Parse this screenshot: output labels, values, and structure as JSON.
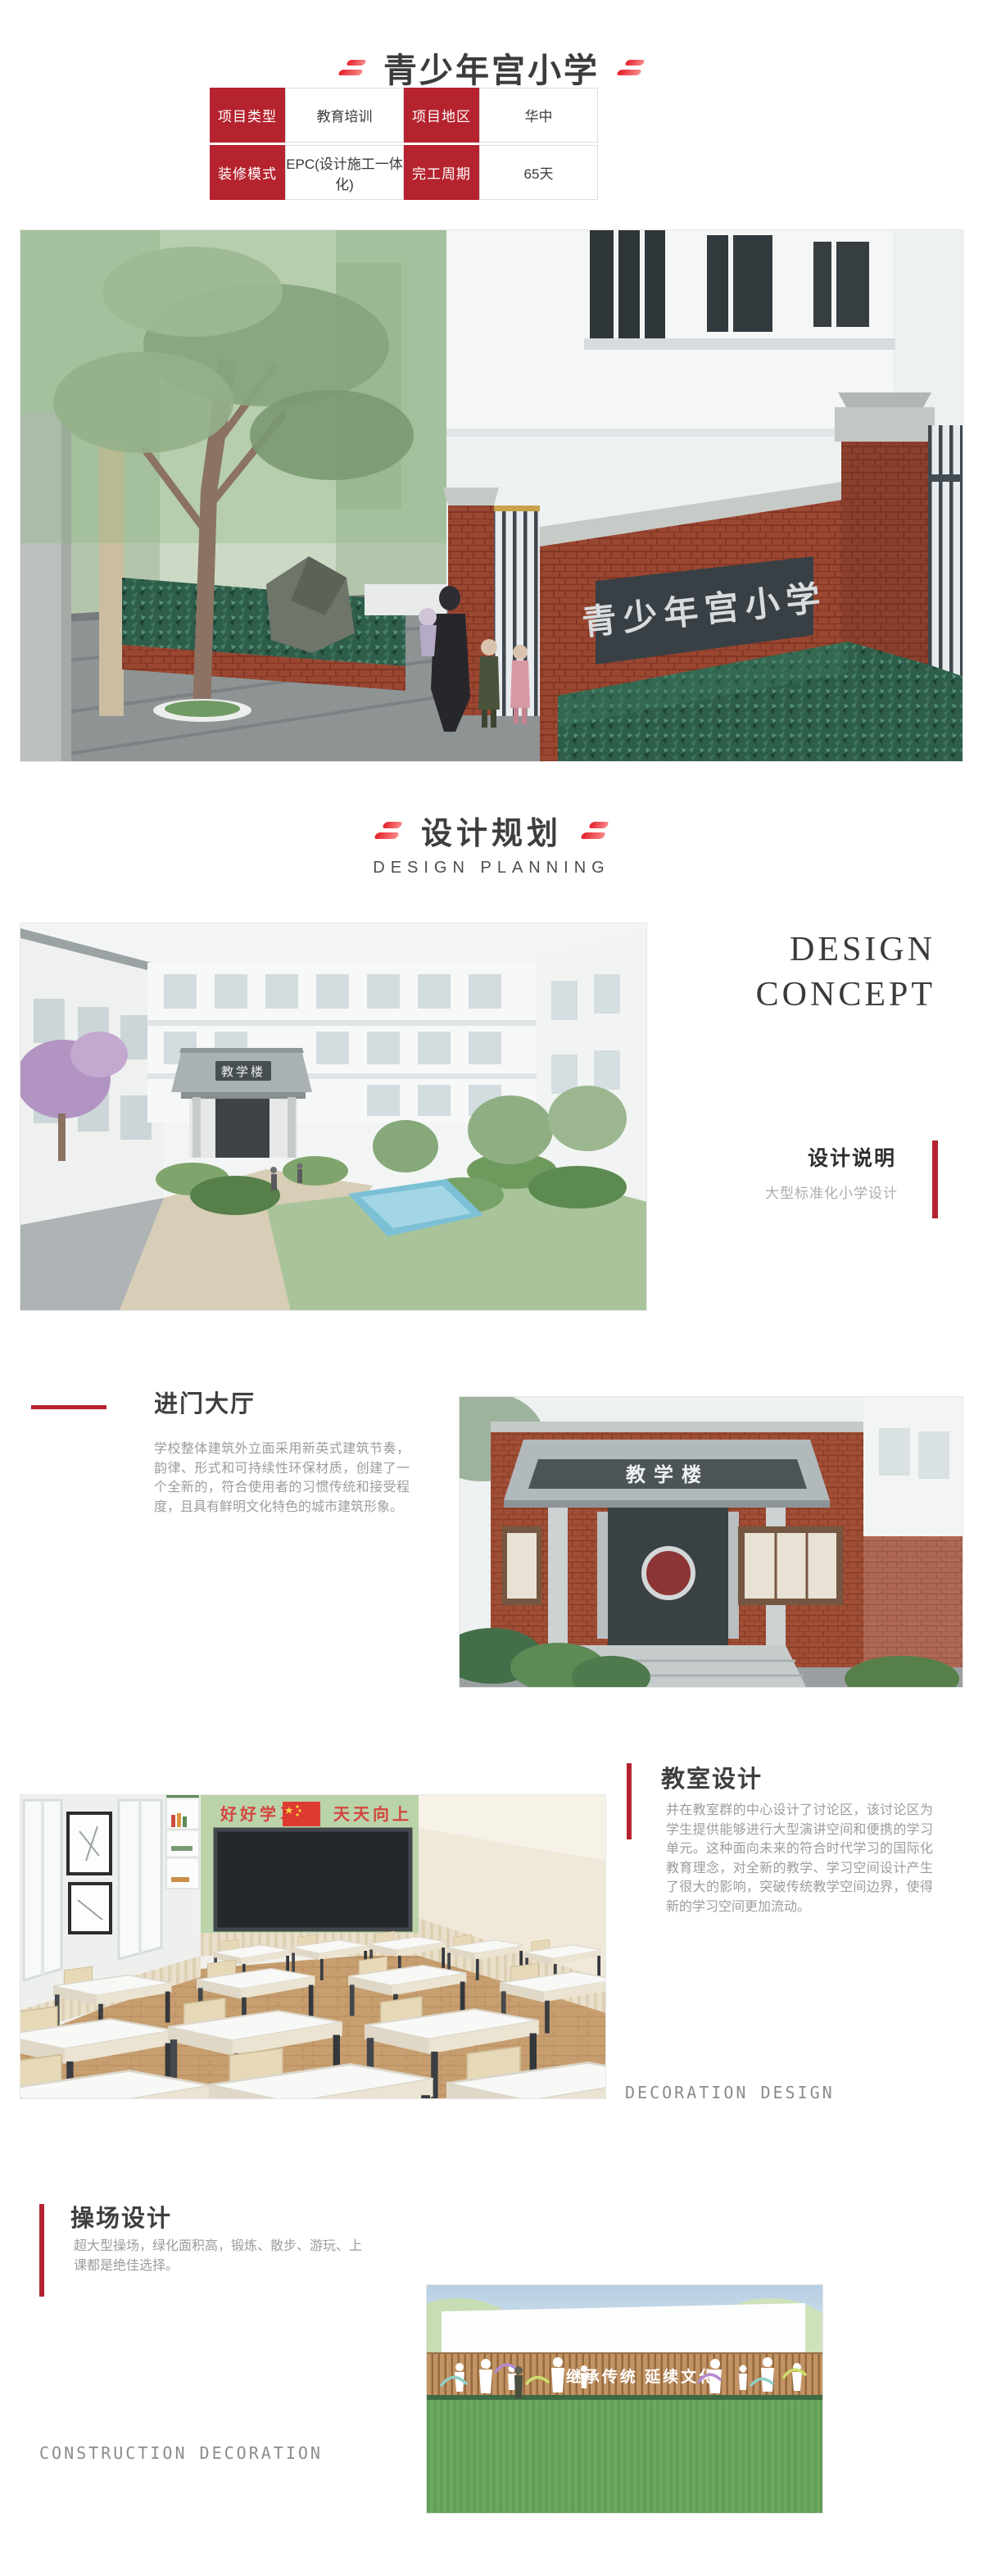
{
  "colors": {
    "accent_red": "#b5232f",
    "dash_red": "#e3202a",
    "slogan_red": "#d4453e"
  },
  "page": {
    "title": "青少年宫小学"
  },
  "info_table": {
    "rows": [
      {
        "cells": [
          {
            "text": "项目类型"
          },
          {
            "text": "教育培训"
          },
          {
            "text": "项目地区"
          },
          {
            "text": "华中"
          }
        ]
      },
      {
        "cells": [
          {
            "text": "装修模式"
          },
          {
            "text": "EPC(设计施工一体化)"
          },
          {
            "text": "完工周期"
          },
          {
            "text": "65天"
          }
        ]
      }
    ]
  },
  "section_header": {
    "title_cn": "设计规划",
    "title_en": "DESIGN PLANNING"
  },
  "design_concept": {
    "line1": "DESIGN",
    "line2": "CONCEPT",
    "subtitle": "设计说明",
    "note": "大型标准化小学设计"
  },
  "entrance_hall": {
    "title": "进门大厅",
    "paragraph": "学校整体建筑外立面采用新英式建筑节奏，韵律、形式和可持续性环保材质，创建了一个全新的，符合使用者的习惯传统和接受程度，且具有鲜明文化特色的城市建筑形象。"
  },
  "classroom": {
    "title": "教室设计",
    "paragraph": "并在教室群的中心设计了讨论区，该讨论区为学生提供能够进行大型演讲空间和便携的学习单元。这种面向未来的符合时代学习的国际化教育理念，对全新的教学、学习空间设计产生了很大的影响，突破传统教学空间边界，使得新的学习空间更加流动。",
    "footer": "DECORATION DESIGN"
  },
  "playground": {
    "title": "操场设计",
    "paragraph": "超大型操场，绿化面积高，锻炼、散步、游玩、上课都是绝佳选择。",
    "footer": "CONSTRUCTION DECORATION"
  },
  "hero_image": {
    "gate_sign": "青少年宫小学"
  },
  "concept_image": {
    "building_sign": "教学楼"
  },
  "entrance_image": {
    "building_sign": "教学楼"
  },
  "classroom_image": {
    "slogan_left": "好好学习",
    "slogan_right": "天天向上"
  },
  "playground_image": {
    "wall_slogan": "继承传统 延续文化"
  }
}
